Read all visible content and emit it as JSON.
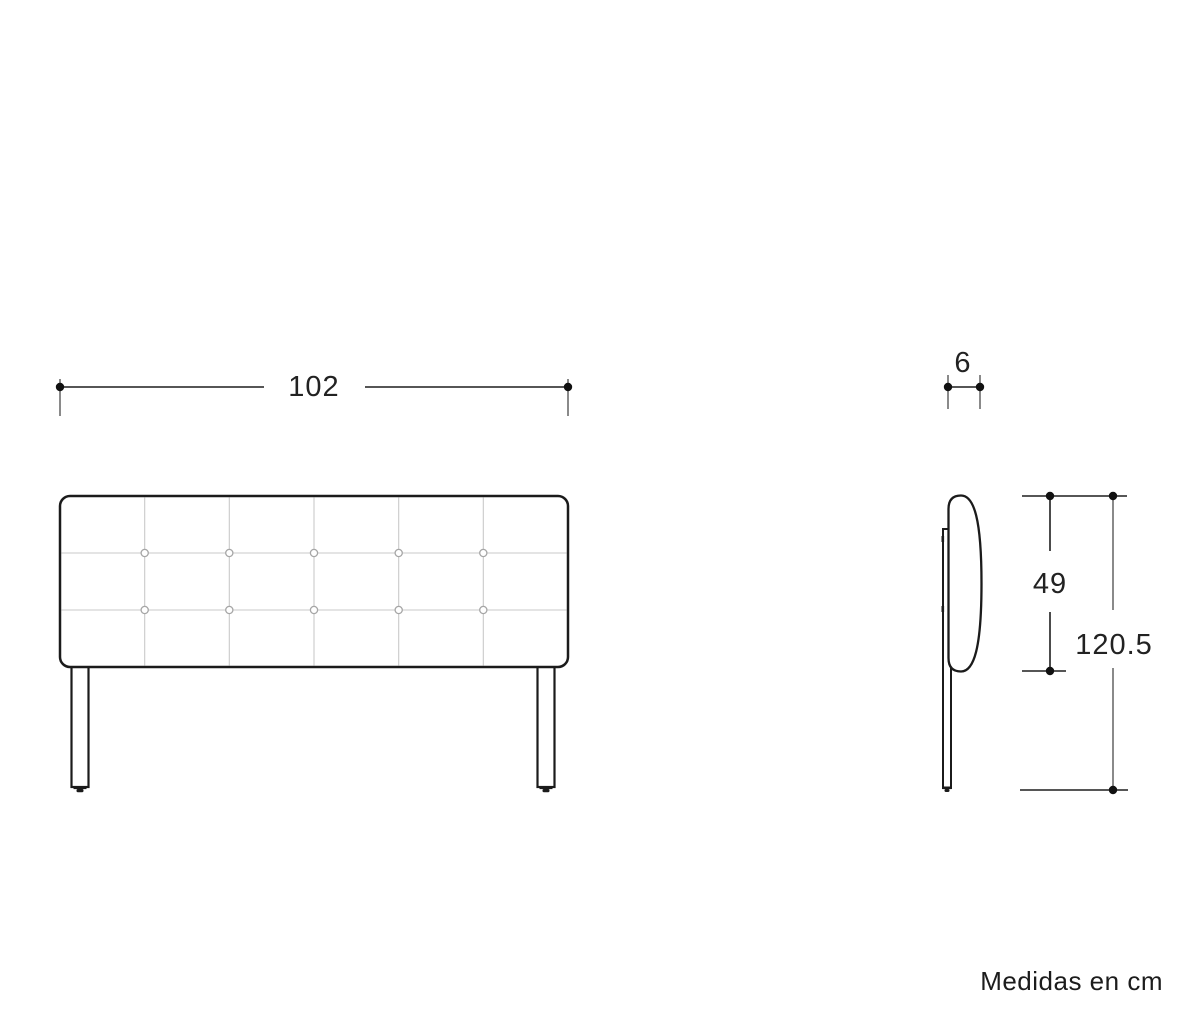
{
  "figure": {
    "subject": "headboard-dimension-diagram",
    "units_note": "Medidas en cm"
  },
  "dimensions": {
    "width_cm": "102",
    "depth_cm": "6",
    "panel_height_cm": "49",
    "total_height_cm": "120.5"
  },
  "front_view": {
    "tufting_columns": 6,
    "tufting_rows": 3,
    "button_count": 10,
    "leg_count": 2
  },
  "colors": {
    "line": "#1b1b1b",
    "dimension_line": "#1f1f1f",
    "extension_line": "#8a8a8a",
    "tufting_grid": "#c9c9c9",
    "button_outline": "#a6a6a6",
    "background": "#ffffff"
  }
}
